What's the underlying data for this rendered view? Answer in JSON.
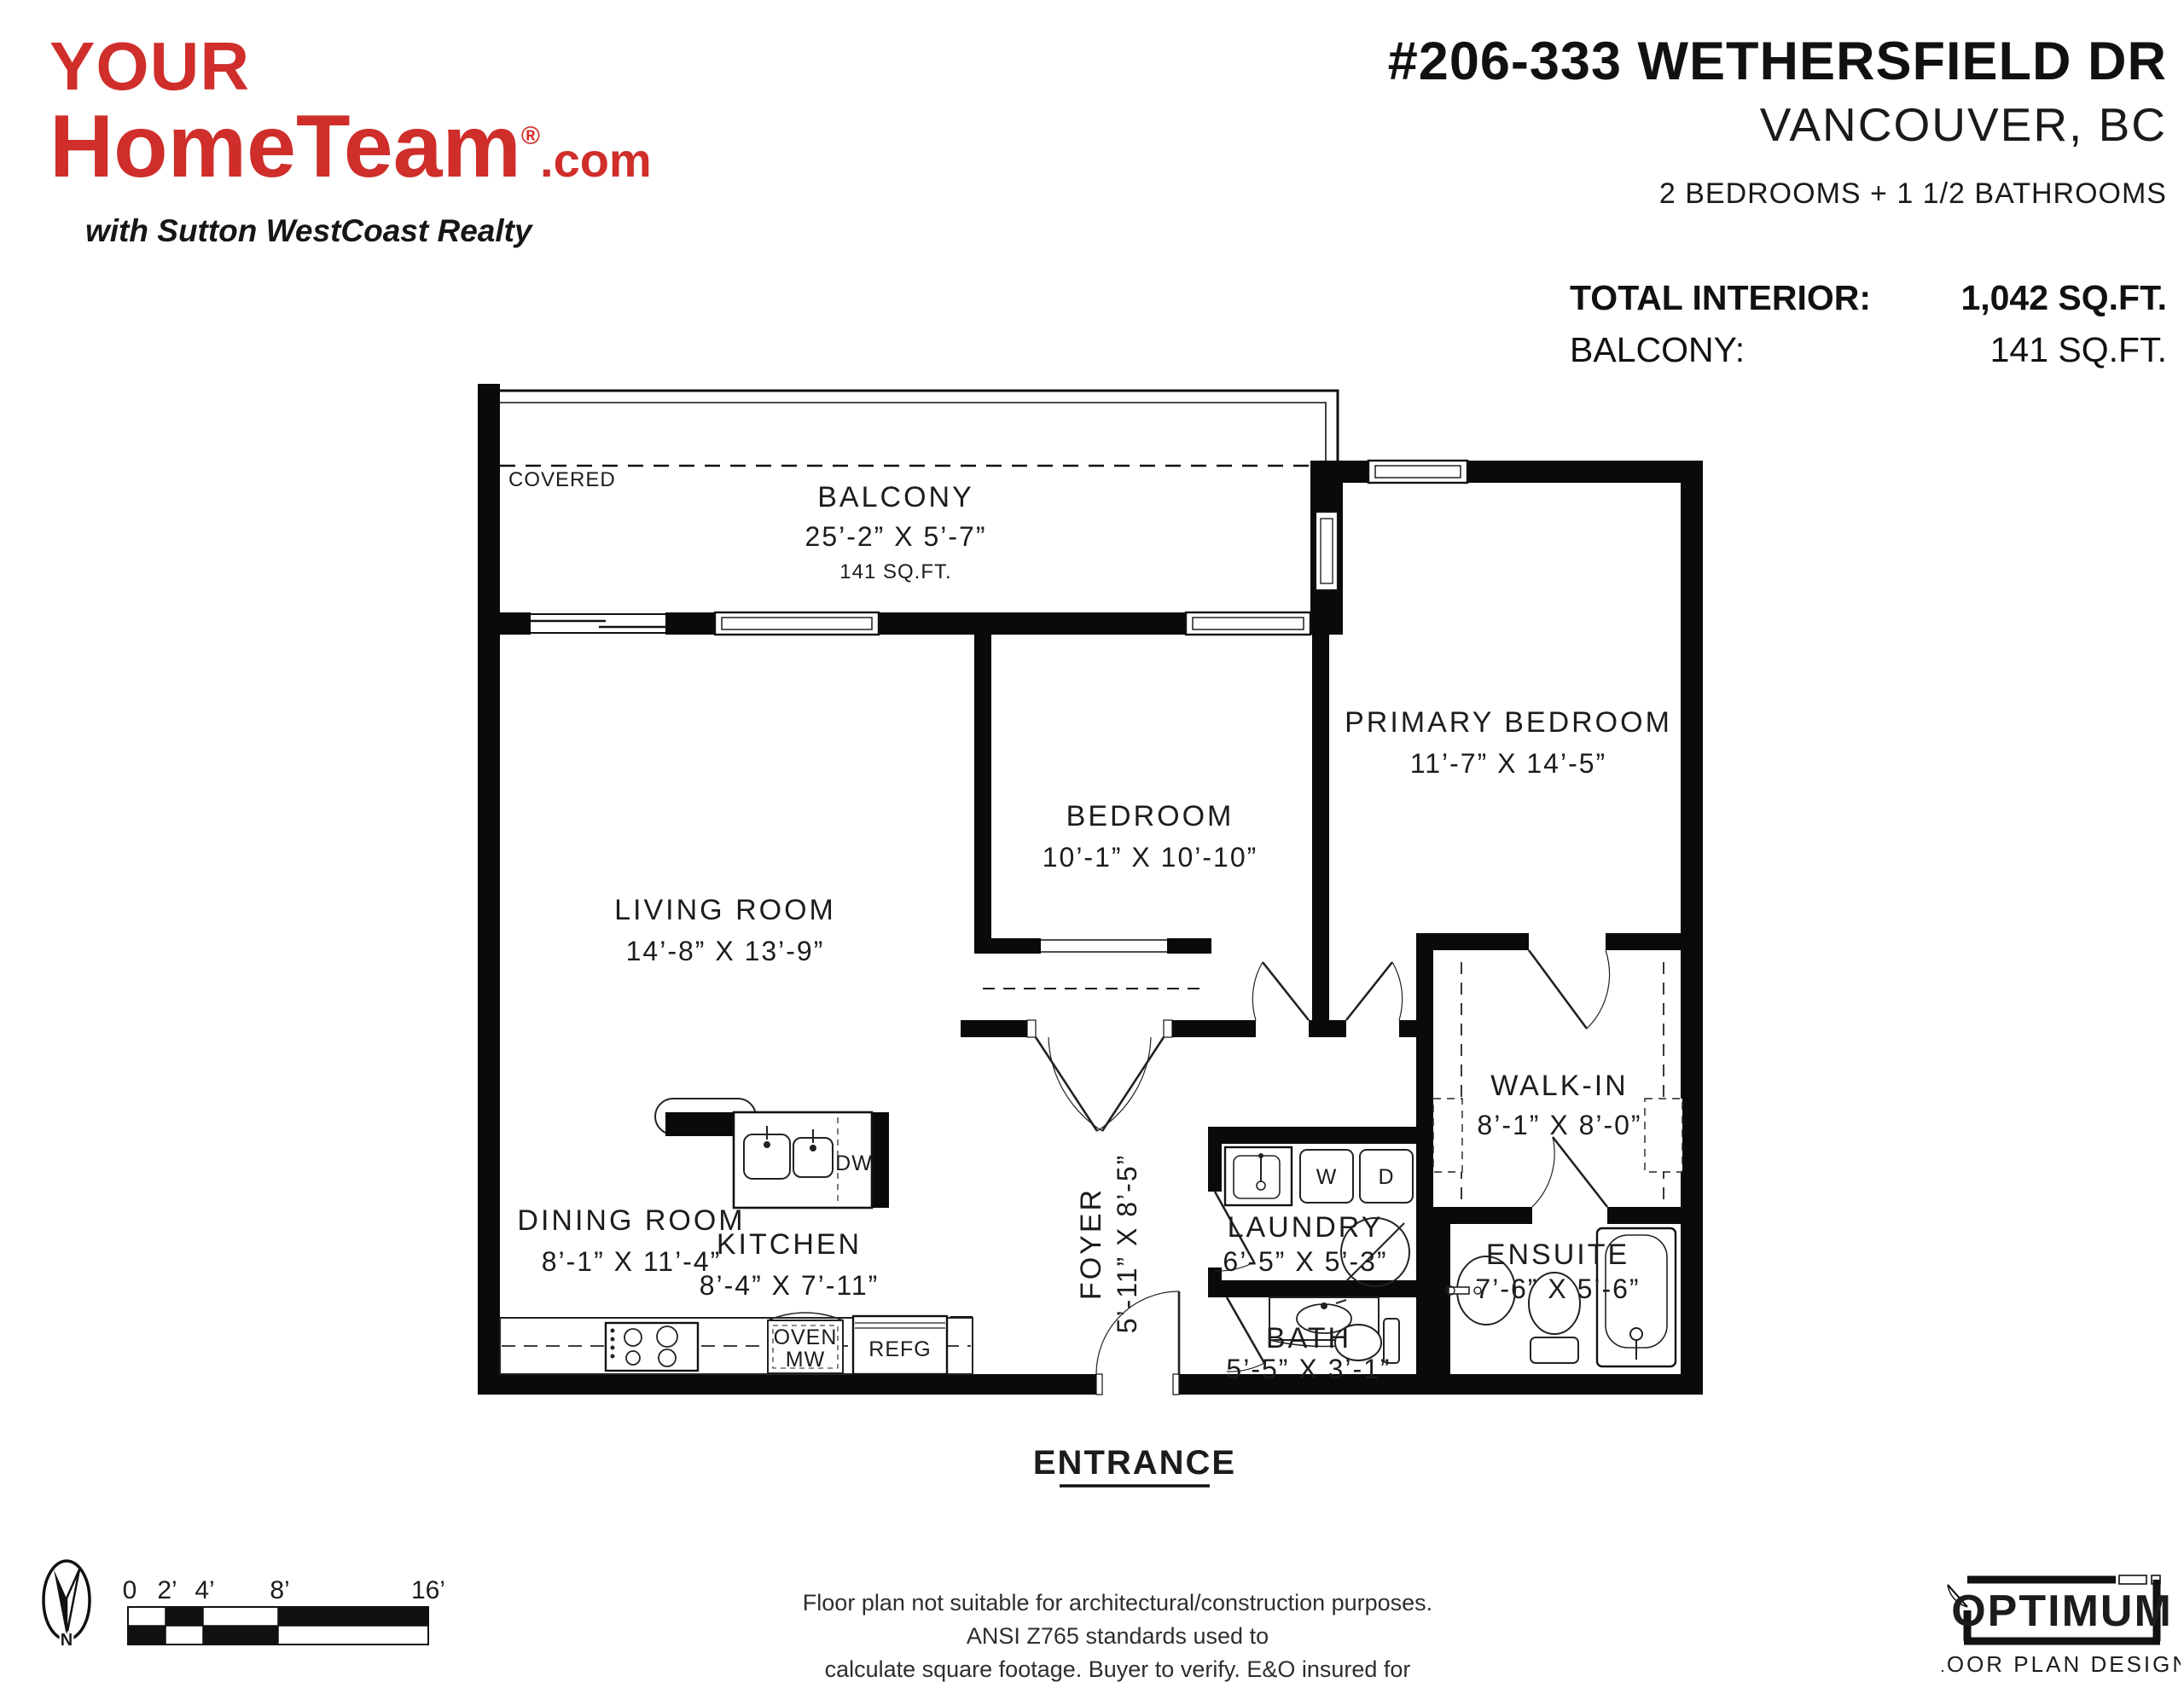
{
  "brand": {
    "line1": "YOUR",
    "line2": "HomeTeam",
    "registered": "®",
    "suffix": ".com",
    "tagline": "with Sutton WestCoast Realty",
    "accent_color": "#cf2e2b"
  },
  "header": {
    "title": "#206-333 WETHERSFIELD DR",
    "city": "VANCOUVER, BC",
    "config": "2 BEDROOMS + 1 1/2 BATHROOMS",
    "stats": [
      {
        "label": "TOTAL INTERIOR:",
        "value": "1,042 SQ.FT."
      },
      {
        "label": "BALCONY:",
        "value": "141 SQ.FT."
      }
    ]
  },
  "plan": {
    "balcony": {
      "covered_label": "COVERED",
      "name": "BALCONY",
      "dims": "25’-2” X 5’-7”",
      "area": "141 SQ.FT."
    },
    "rooms": [
      {
        "name": "LIVING ROOM",
        "dims": "14’-8” X 13’-9”"
      },
      {
        "name": "BEDROOM",
        "dims": "10’-1” X 10’-10”"
      },
      {
        "name": "PRIMARY BEDROOM",
        "dims": "11’-7” X 14’-5”"
      },
      {
        "name": "WALK-IN",
        "dims": "8’-1” X 8’-0”"
      },
      {
        "name": "DINING ROOM",
        "dims": "8’-1” X 11’-4”"
      },
      {
        "name": "KITCHEN",
        "dims": "8’-4” X 7’-11”"
      },
      {
        "name": "FOYER",
        "dims": "5’-11” X 8’-5”"
      },
      {
        "name": "LAUNDRY",
        "dims": "6’-5” X 5’-3”"
      },
      {
        "name": "BATH",
        "dims": "5’-5” X 3’-1”"
      },
      {
        "name": "ENSUITE",
        "dims": "7’-6” X 5’-6”"
      }
    ],
    "fixtures": {
      "dishwasher": "DW",
      "washer": "W",
      "dryer": "D",
      "oven_line1": "OVEN",
      "oven_line2": "MW",
      "fridge": "REFG"
    },
    "entrance_label": "ENTRANCE"
  },
  "footer": {
    "north_label": "N",
    "scale_ticks": [
      "0",
      "2’",
      "4’",
      "8’",
      "16’"
    ],
    "disclaimer_line1": "Floor plan not suitable for architectural/construction purposes. ANSI Z765 standards used to",
    "disclaimer_line2": "calculate square footage. Buyer to verify.  E&O insured for $1,000,000.",
    "credit_line1": "OPTIMUM",
    "credit_line2": "FLOOR PLAN DESIGNS"
  }
}
